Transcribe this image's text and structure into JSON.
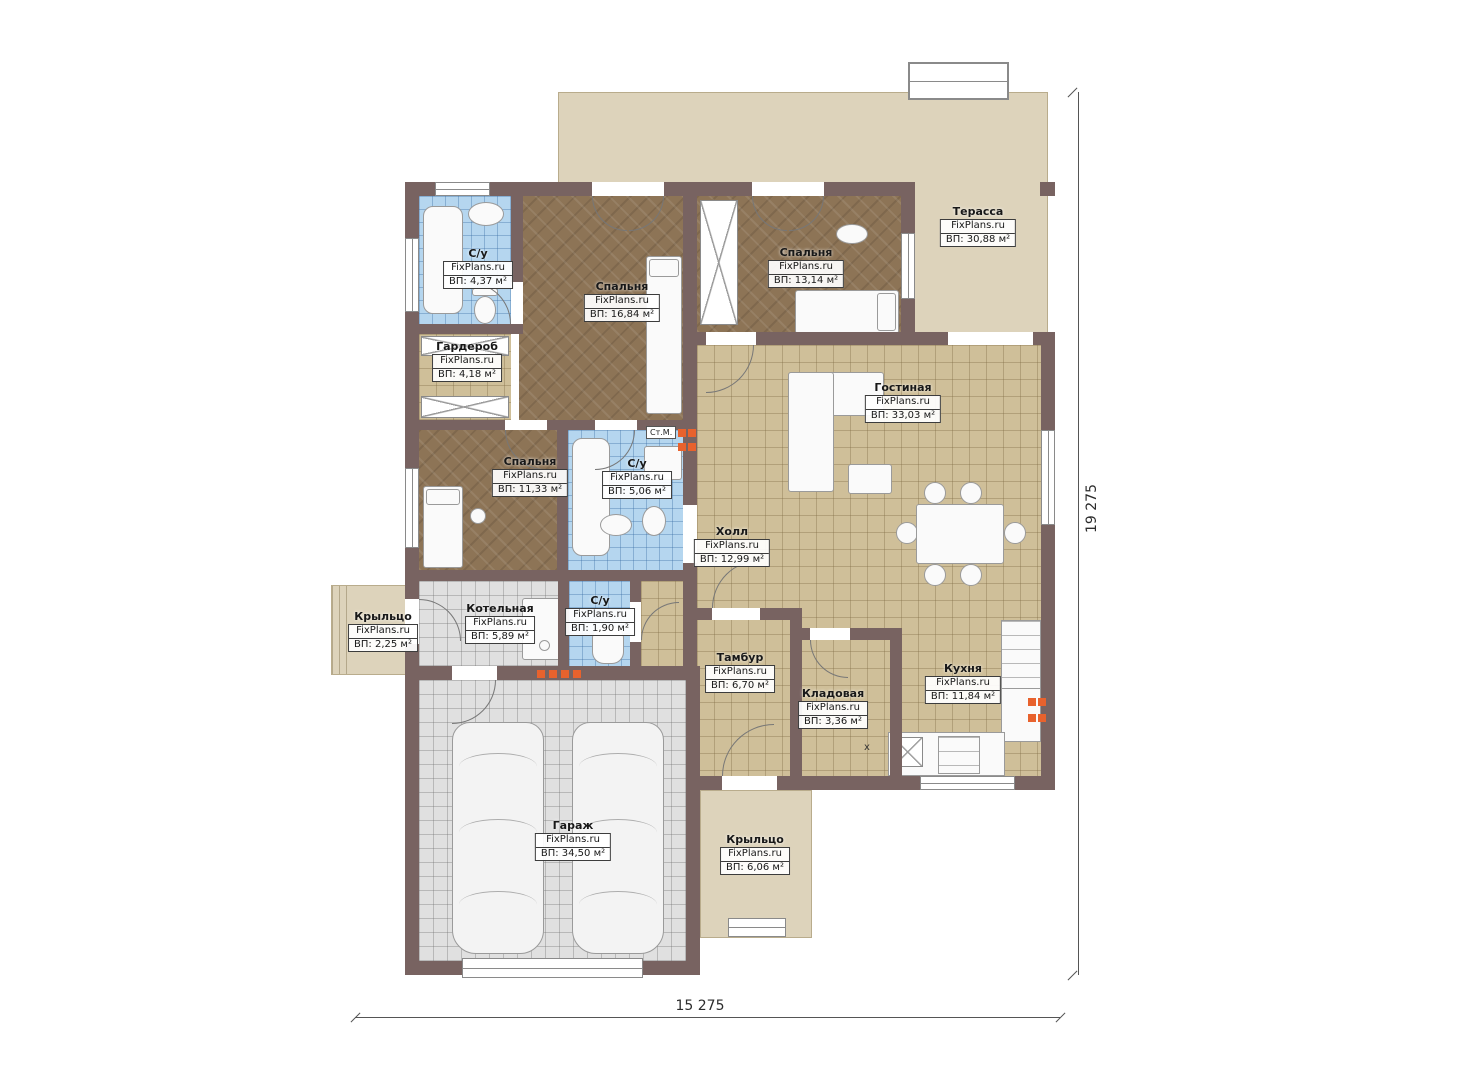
{
  "watermark": "FixPlans.ru",
  "dimensions": {
    "width_label": "15 275",
    "height_label": "19 275"
  },
  "annotations": {
    "washing_machine": "Ст.М.",
    "sink_mark": "x"
  },
  "colors": {
    "wall": "#786361",
    "floor_tile_tan": "#cfbf99",
    "floor_wood": "#8d7456",
    "floor_tile_blue": "#b5d6ef",
    "floor_tile_grey": "#e0e0e0",
    "terrace_beige": "#ddd3bb",
    "accent_orange": "#e8622d"
  },
  "rooms": [
    {
      "name": "Терасса",
      "wm": "FixPlans.ru",
      "area": "ВП: 30,88 м²"
    },
    {
      "name": "С/у",
      "wm": "FixPlans.ru",
      "area": "ВП: 4,37 м²"
    },
    {
      "name": "Спальня",
      "wm": "FixPlans.ru",
      "area": "ВП: 16,84 м²"
    },
    {
      "name": "Спальня",
      "wm": "FixPlans.ru",
      "area": "ВП: 13,14 м²"
    },
    {
      "name": "Гардероб",
      "wm": "FixPlans.ru",
      "area": "ВП: 4,18 м²"
    },
    {
      "name": "Гостиная",
      "wm": "FixPlans.ru",
      "area": "ВП: 33,03 м²"
    },
    {
      "name": "Спальня",
      "wm": "FixPlans.ru",
      "area": "ВП: 11,33 м²"
    },
    {
      "name": "С/у",
      "wm": "FixPlans.ru",
      "area": "ВП: 5,06 м²"
    },
    {
      "name": "Холл",
      "wm": "FixPlans.ru",
      "area": "ВП: 12,99 м²"
    },
    {
      "name": "Котельная",
      "wm": "FixPlans.ru",
      "area": "ВП: 5,89 м²"
    },
    {
      "name": "С/у",
      "wm": "FixPlans.ru",
      "area": "ВП: 1,90 м²"
    },
    {
      "name": "Крыльцо",
      "wm": "FixPlans.ru",
      "area": "ВП: 2,25 м²"
    },
    {
      "name": "Тамбур",
      "wm": "FixPlans.ru",
      "area": "ВП: 6,70 м²"
    },
    {
      "name": "Кладовая",
      "wm": "FixPlans.ru",
      "area": "ВП: 3,36 м²"
    },
    {
      "name": "Кухня",
      "wm": "FixPlans.ru",
      "area": "ВП: 11,84 м²"
    },
    {
      "name": "Гараж",
      "wm": "FixPlans.ru",
      "area": "ВП: 34,50 м²"
    },
    {
      "name": "Крыльцо",
      "wm": "FixPlans.ru",
      "area": "ВП: 6,06 м²"
    }
  ]
}
